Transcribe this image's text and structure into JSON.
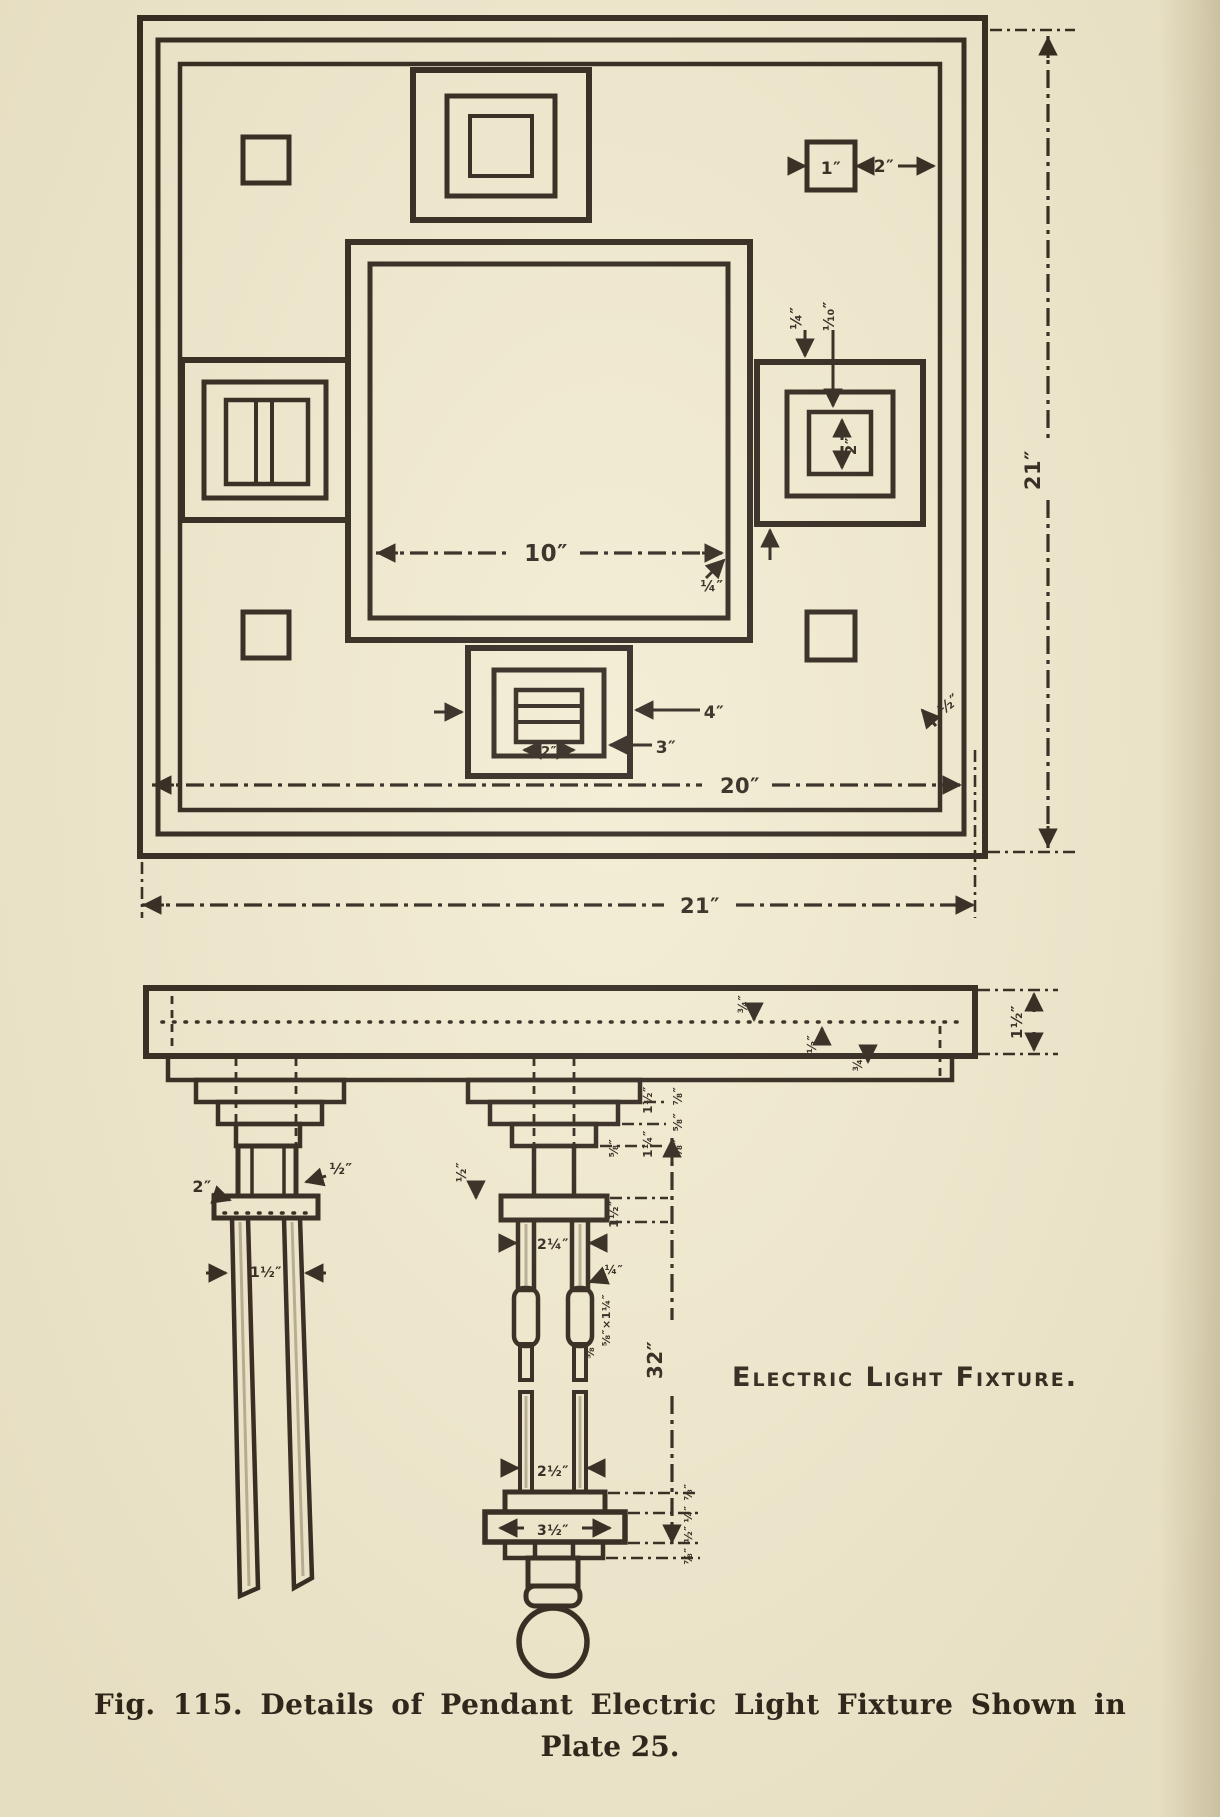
{
  "palette": {
    "paper": "#f2ecd2",
    "ink": "#2c231a"
  },
  "figure": {
    "caption_line1": "Fig. 115.  Details of Pendant Electric Light Fixture Shown in",
    "caption_line2": "Plate 25."
  },
  "note": "Electric Light Fixture.",
  "views": {
    "plan": "Plan of square ceiling plate with nested square blocks",
    "elevation": "Section / elevation of ceiling board with two pendant stems and lamp bulb"
  },
  "annotations": {
    "plan": [
      {
        "text": "1″",
        "x": 831,
        "y": 174,
        "fs": 17,
        "rot": 0
      },
      {
        "text": "2″",
        "x": 884,
        "y": 172,
        "fs": 17,
        "rot": 0
      },
      {
        "text": "¼″",
        "x": 801,
        "y": 318,
        "fs": 15,
        "rot": -90
      },
      {
        "text": "⅒″",
        "x": 834,
        "y": 316,
        "fs": 15,
        "rot": -90
      },
      {
        "text": "2″",
        "x": 856,
        "y": 446,
        "fs": 15,
        "rot": -90
      },
      {
        "text": "10″",
        "x": 546,
        "y": 561,
        "fs": 23,
        "rot": 0
      },
      {
        "text": "¼″",
        "x": 712,
        "y": 591,
        "fs": 15,
        "rot": 0
      },
      {
        "text": "4″",
        "x": 714,
        "y": 718,
        "fs": 17,
        "rot": 0
      },
      {
        "text": "3″",
        "x": 666,
        "y": 753,
        "fs": 17,
        "rot": 0
      },
      {
        "text": "2″",
        "x": 549,
        "y": 756,
        "fs": 13,
        "rot": 0
      },
      {
        "text": "20″",
        "x": 740,
        "y": 793,
        "fs": 21,
        "rot": 0
      },
      {
        "text": "21″",
        "x": 700,
        "y": 913,
        "fs": 21,
        "rot": 0
      },
      {
        "text": "21″",
        "x": 1040,
        "y": 470,
        "fs": 21,
        "rot": -90
      },
      {
        "text": "½″",
        "x": 952,
        "y": 708,
        "fs": 15,
        "rot": -40
      }
    ],
    "elevation": [
      {
        "text": "1½″",
        "x": 1022,
        "y": 1022,
        "fs": 15,
        "rot": -90
      },
      {
        "text": "¾″",
        "x": 747,
        "y": 1004,
        "fs": 12,
        "rot": -90
      },
      {
        "text": "½″",
        "x": 816,
        "y": 1044,
        "fs": 12,
        "rot": -90
      },
      {
        "text": "¾″",
        "x": 862,
        "y": 1062,
        "fs": 12,
        "rot": -90
      },
      {
        "text": "2″",
        "x": 202,
        "y": 1192,
        "fs": 16,
        "rot": 0
      },
      {
        "text": "½″",
        "x": 341,
        "y": 1174,
        "fs": 15,
        "rot": 0
      },
      {
        "text": "1½″",
        "x": 266,
        "y": 1277,
        "fs": 14,
        "rot": 0
      },
      {
        "text": "½″",
        "x": 466,
        "y": 1172,
        "fs": 13,
        "rot": -90
      },
      {
        "text": "⅞″",
        "x": 682,
        "y": 1096,
        "fs": 12,
        "rot": -90
      },
      {
        "text": "⅝″",
        "x": 682,
        "y": 1122,
        "fs": 12,
        "rot": -90
      },
      {
        "text": "⅝″",
        "x": 682,
        "y": 1148,
        "fs": 12,
        "rot": -90
      },
      {
        "text": "1½″",
        "x": 652,
        "y": 1100,
        "fs": 12,
        "rot": -90
      },
      {
        "text": "1¼″",
        "x": 652,
        "y": 1144,
        "fs": 12,
        "rot": -90
      },
      {
        "text": "⅝″",
        "x": 618,
        "y": 1148,
        "fs": 12,
        "rot": -90
      },
      {
        "text": "1½″",
        "x": 618,
        "y": 1214,
        "fs": 12,
        "rot": -90
      },
      {
        "text": "2¼″",
        "x": 553,
        "y": 1249,
        "fs": 14,
        "rot": 0
      },
      {
        "text": "¼″",
        "x": 614,
        "y": 1274,
        "fs": 12,
        "rot": 0
      },
      {
        "text": "⅝″×1¼″",
        "x": 610,
        "y": 1320,
        "fs": 11,
        "rot": -90
      },
      {
        "text": "⅝″",
        "x": 594,
        "y": 1350,
        "fs": 11,
        "rot": -90
      },
      {
        "text": "2½″",
        "x": 553,
        "y": 1476,
        "fs": 14,
        "rot": 0
      },
      {
        "text": "3½″",
        "x": 553,
        "y": 1535,
        "fs": 14,
        "rot": 0
      },
      {
        "text": "32″",
        "x": 662,
        "y": 1360,
        "fs": 20,
        "rot": -90
      },
      {
        "text": "⅞″",
        "x": 692,
        "y": 1492,
        "fs": 11,
        "rot": -90
      },
      {
        "text": "¼″",
        "x": 692,
        "y": 1514,
        "fs": 11,
        "rot": -90
      },
      {
        "text": "½″",
        "x": 692,
        "y": 1534,
        "fs": 11,
        "rot": -90
      },
      {
        "text": "⅞″",
        "x": 692,
        "y": 1556,
        "fs": 11,
        "rot": -90
      }
    ]
  }
}
